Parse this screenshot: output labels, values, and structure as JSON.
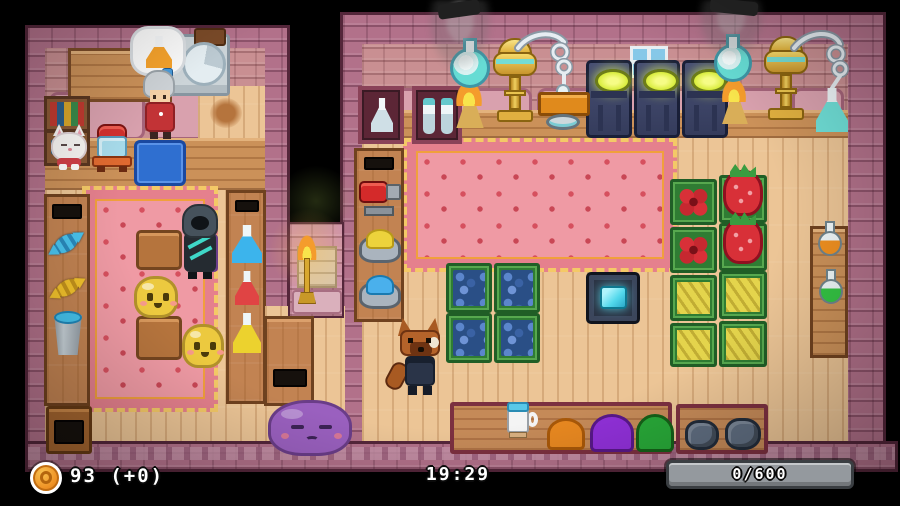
{
  "hud": {
    "money": {
      "icon": "coin-icon",
      "display": "93 (+0)",
      "value": 93,
      "delta": "+0"
    },
    "clock": {
      "time": "19:29"
    },
    "progress": {
      "display": "0/600",
      "current": 0,
      "max": 600
    }
  },
  "palette": {
    "background": "#000000",
    "wall_brick": "#b2718a",
    "wall_outline": "#54263a",
    "backwall_salmon": "#c98f92",
    "floor_wood": "#ecc596",
    "counter_wood": "#cb9159",
    "carpet_pink": "#ef9aa4",
    "carpet_trim_gold": "#f4c967",
    "hud_text": "#ffffff",
    "progress_track": "#94999e",
    "coin_orange": "#f09c2c",
    "machine_glow": "#d8ec3c",
    "pad_crystal": "#52d8ec",
    "slime_yellow": "#ecc93f",
    "slime_purple": "#9a60bf"
  },
  "scene": {
    "rooms": [
      "shop-room-left",
      "workshop-room-right"
    ],
    "entities": [
      "speech-bubble-potion",
      "wall-clock",
      "shopkeeper-npc",
      "white-cat-creature",
      "potion-jar-machine",
      "blue-counter-mat",
      "bookshelf",
      "wooden-shelf",
      "white-cabinet",
      "candy-blue",
      "candy-yellow",
      "water-bucket",
      "flask-blue",
      "flask-red",
      "flask-yellow",
      "hooded-customer",
      "yellow-slime",
      "yellow-slime",
      "purple-slime",
      "wall-torch",
      "storage-cabinet",
      "display-case-flask",
      "display-case-flasks",
      "wall-window",
      "cauldron-machine",
      "cauldron-machine",
      "cauldron-machine",
      "alembic-still",
      "alembic-still",
      "heated-flask",
      "heated-flask",
      "oil-lamp",
      "work-table",
      "mixing-bowl",
      "extinguisher-tank",
      "yellow-powder-bowl",
      "blue-powder-bowl",
      "blueberry-crate",
      "flower-crate",
      "strawberry-crate",
      "banana-crate",
      "teleport-pad",
      "player-fox",
      "mug",
      "orange-powder-pile",
      "purple-powder-pile",
      "green-powder-pile",
      "ore-pile",
      "potion-orange",
      "potion-green",
      "side-table",
      "bench",
      "small-table"
    ]
  }
}
